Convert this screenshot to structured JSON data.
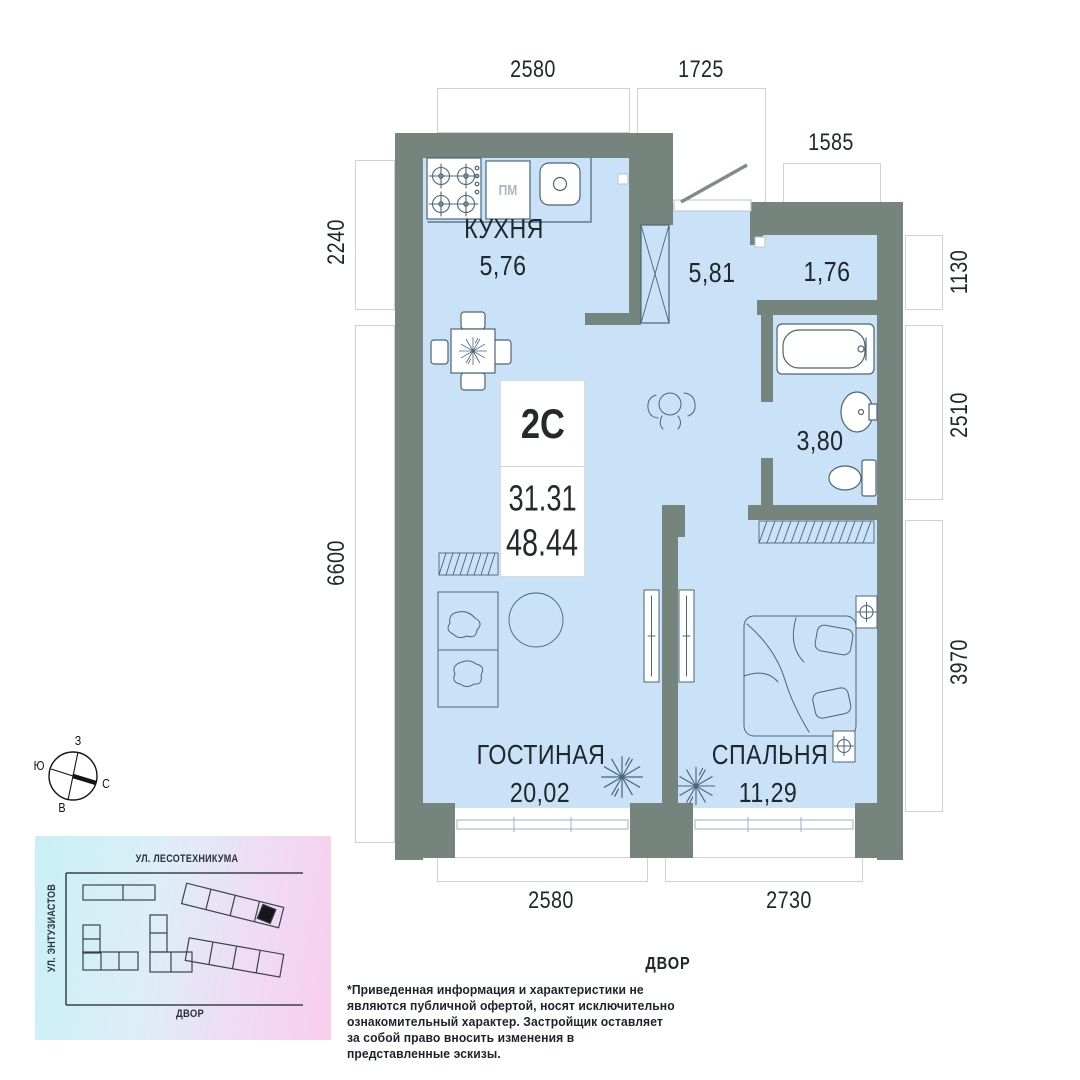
{
  "unit": {
    "type": "2С",
    "area_living": "31.31",
    "area_total": "48.44"
  },
  "rooms": {
    "kitchen": {
      "name": "КУХНЯ",
      "area": "5,76"
    },
    "hallway": {
      "area": "5,81"
    },
    "storage": {
      "area": "1,76"
    },
    "bathroom": {
      "area": "3,80"
    },
    "living": {
      "name": "ГОСТИНАЯ",
      "area": "20,02"
    },
    "bedroom": {
      "name": "СПАЛЬНЯ",
      "area": "11,29"
    }
  },
  "appliances": {
    "dishwasher": "ПМ"
  },
  "dimensions": {
    "top": {
      "d1": "2580",
      "d2": "1725",
      "d3": "1585"
    },
    "left": {
      "d1": "2240",
      "d2": "6600"
    },
    "right": {
      "d1": "1130",
      "d2": "2510",
      "d3": "3970"
    },
    "bottom": {
      "d1": "2580",
      "d2": "2730"
    }
  },
  "compass": {
    "west": "З",
    "south": "Ю",
    "north": "С",
    "east": "В"
  },
  "sitemap": {
    "street_top": "УЛ. ЛЕСОТЕХНИКУМА",
    "street_left": "УЛ. ЭНТУЗИАСТОВ",
    "yard": "ДВОР"
  },
  "yard_label": "ДВОР",
  "disclaimer": "*Приведенная информация и характеристики не являются публичной офертой, носят исключительно ознакомительный характер. Застройщик оставляет за собой право вносить изменения в представленные эскизы.",
  "colors": {
    "wall": "#75857D",
    "floor": "#C9E2F8",
    "furniture_line": "#4A6478",
    "dim_border": "#CCD2D5",
    "highlight_building": "#161616"
  }
}
